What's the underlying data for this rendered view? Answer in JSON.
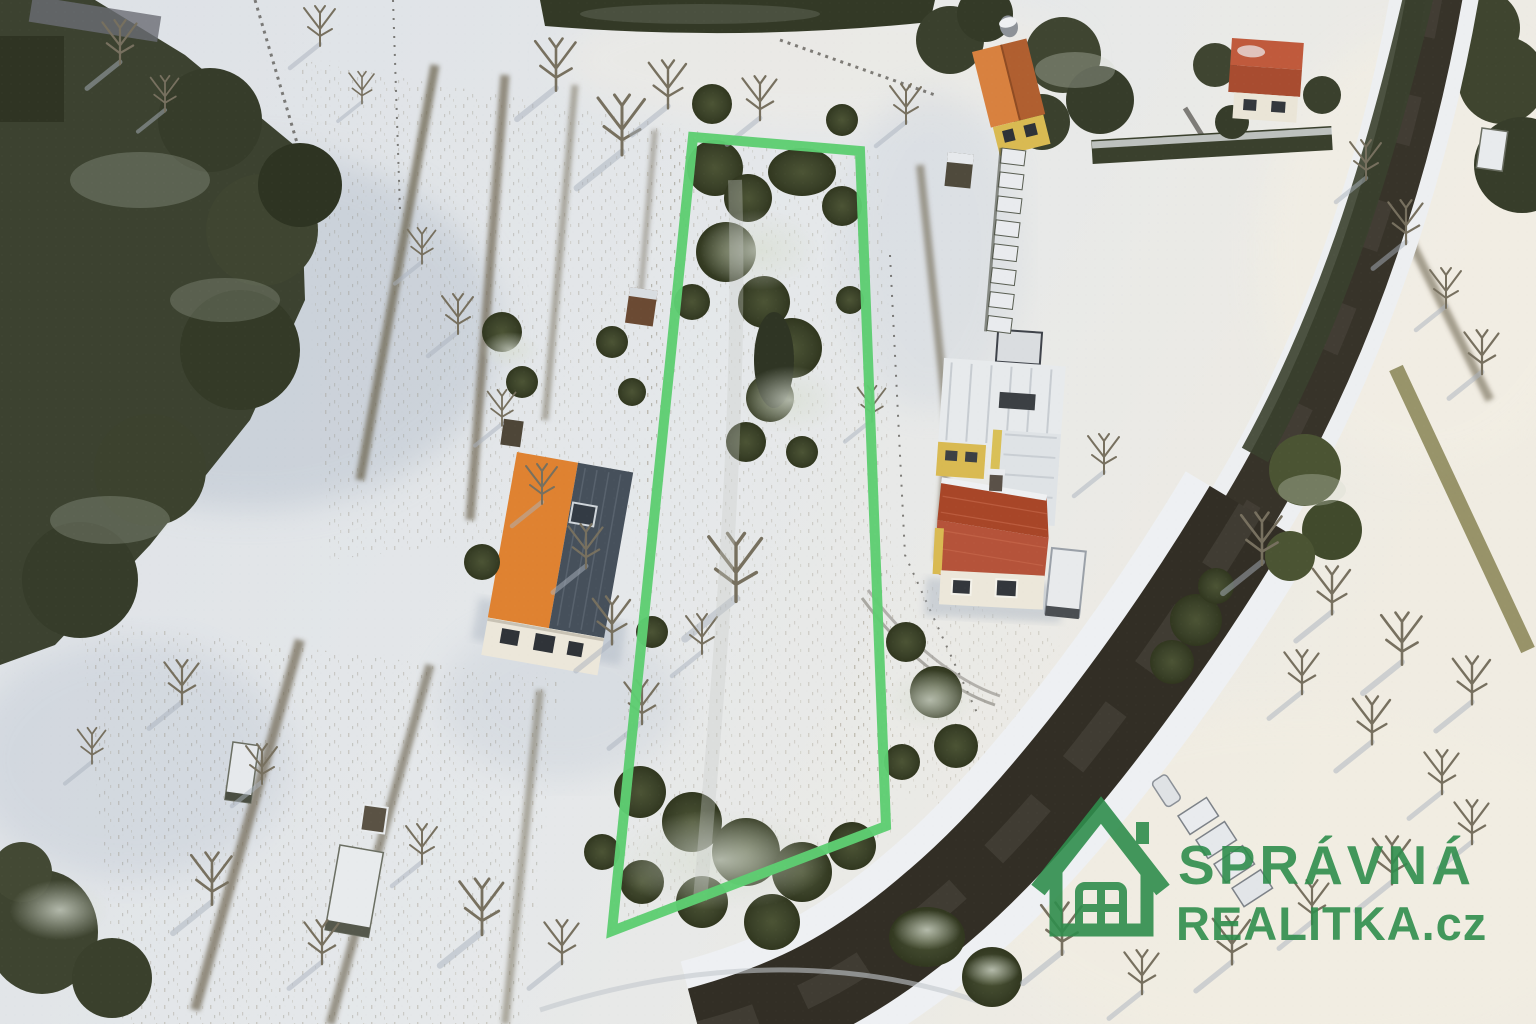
{
  "photo": {
    "kind": "aerial-winter-drone-photo",
    "description": "Snow-covered garden plots with bare trees and hedges, an elongated land parcel outlined in green, a house with an orange/slate roof, a red-roofed house with outbuildings, small sheds and beehives, and a dark asphalt road curving from top right to bottom centre."
  },
  "plot_outline": {
    "points": "693,137 860,151 886,826 612,931",
    "color": "#5ecd72",
    "stroke_width": 10
  },
  "watermark": {
    "line1": "SPRÁVNÁ",
    "line2": "REALITKA.cz",
    "color": "#2f8d4d",
    "icon": "house-logo-icon"
  },
  "palette": {
    "snow_base": "#dfe3e8",
    "snow_bright": "#f2eee3",
    "snow_shadow": "#b9c3cf",
    "stubble": "#8a8069",
    "forest": "#3c4230",
    "bush": "#49522f",
    "snow_dust": "#d3dacd",
    "road_asphalt": "#373329",
    "road_shoulder": "#eef0f3",
    "bare_tree": "#7b7362",
    "grass_verge": "#8e8a5c",
    "orange_roof": "#df8231",
    "slate_roof": "#46505b",
    "red_roof": "#b04b30",
    "cream_wall": "#ece7da",
    "yellow_wall": "#d9ba52",
    "overlay_green": "#5ecd72"
  }
}
